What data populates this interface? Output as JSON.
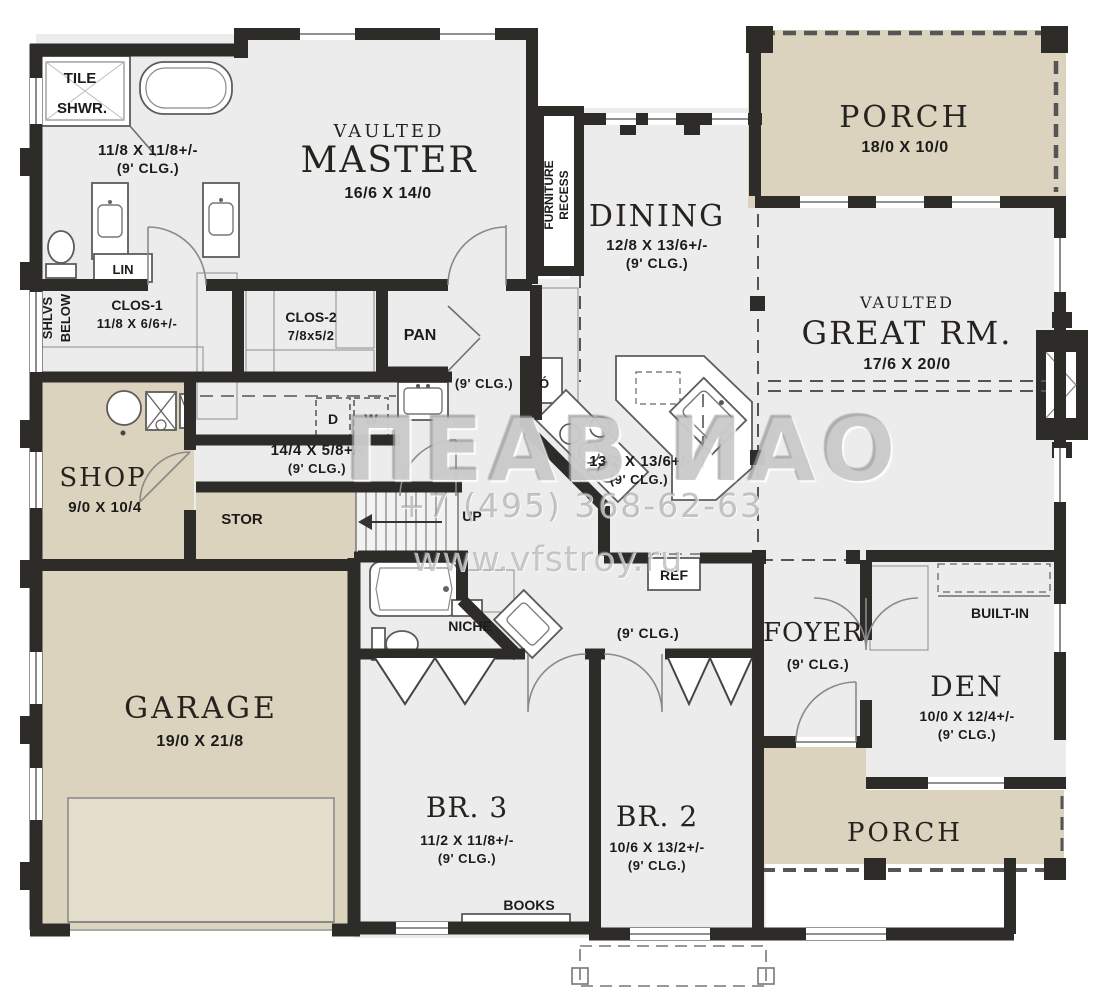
{
  "colors": {
    "wall": "#2d2c29",
    "room_fill": "#ececec",
    "porch_fill": "#dbd3be",
    "text": "#1c1b19",
    "watermark": "#a5a5a5"
  },
  "watermark": {
    "logo": "ПЕАВ ИАО",
    "phone": "+7 (495) 368-62-63",
    "site": "www.vfstroy.ru"
  },
  "rooms": {
    "master_bath": {
      "line1": "TILE",
      "line2": "SHWR.",
      "dims": "11/8 X 11/8+/-",
      "clg": "(9' CLG.)"
    },
    "master": {
      "prefix": "VAULTED",
      "name": "MASTER",
      "dims": "16/6 X 14/0"
    },
    "furniture_recess": {
      "line1": "FURNITURE",
      "line2": "RECESS"
    },
    "dining": {
      "name": "DINING",
      "dims": "12/8 X 13/6+/-",
      "clg": "(9' CLG.)"
    },
    "porch_top": {
      "name": "PORCH",
      "dims": "18/0 X 10/0"
    },
    "great_room": {
      "prefix": "VAULTED",
      "name": "GREAT RM.",
      "dims": "17/6 X 20/0"
    },
    "lin": {
      "name": "LIN"
    },
    "shlvs": {
      "line1": "SHLVS",
      "line2": "BELOW"
    },
    "clos1": {
      "name": "CLOS-1",
      "dims": "11/8 X 6/6+/-"
    },
    "clos2": {
      "name": "CLOS-2",
      "dims": "7/8x5/2"
    },
    "pan": {
      "name": "PAN"
    },
    "laundry": {
      "d": "D",
      "w": "W",
      "dims": "14/4 X 5/8+/-",
      "clg": "(9' CLG.)"
    },
    "hall_upper": {
      "clg": "(9' CLG.)"
    },
    "shop": {
      "name": "SHOP",
      "dims": "9/0 X 10/4"
    },
    "stor": {
      "name": "STOR"
    },
    "stairs": {
      "up": "UP"
    },
    "kitchen": {
      "oven": "Ó",
      "dims": "13/2 X 13/6+/-",
      "clg": "(9' CLG.)",
      "ref": "REF"
    },
    "niche": {
      "name": "NICHE"
    },
    "hall_lower": {
      "clg": "(9' CLG.)"
    },
    "foyer": {
      "name": "FOYER",
      "clg": "(9' CLG.)"
    },
    "built_in": {
      "name": "BUILT-IN"
    },
    "den": {
      "name": "DEN",
      "dims": "10/0 X 12/4+/-",
      "clg": "(9' CLG.)"
    },
    "garage": {
      "name": "GARAGE",
      "dims": "19/0 X 21/8"
    },
    "br3": {
      "name": "BR. 3",
      "dims": "11/2 X 11/8+/-",
      "clg": "(9' CLG.)"
    },
    "br2": {
      "name": "BR. 2",
      "dims": "10/6 X 13/2+/-",
      "clg": "(9' CLG.)"
    },
    "books": {
      "name": "BOOKS"
    },
    "porch_bottom": {
      "name": "PORCH"
    }
  }
}
